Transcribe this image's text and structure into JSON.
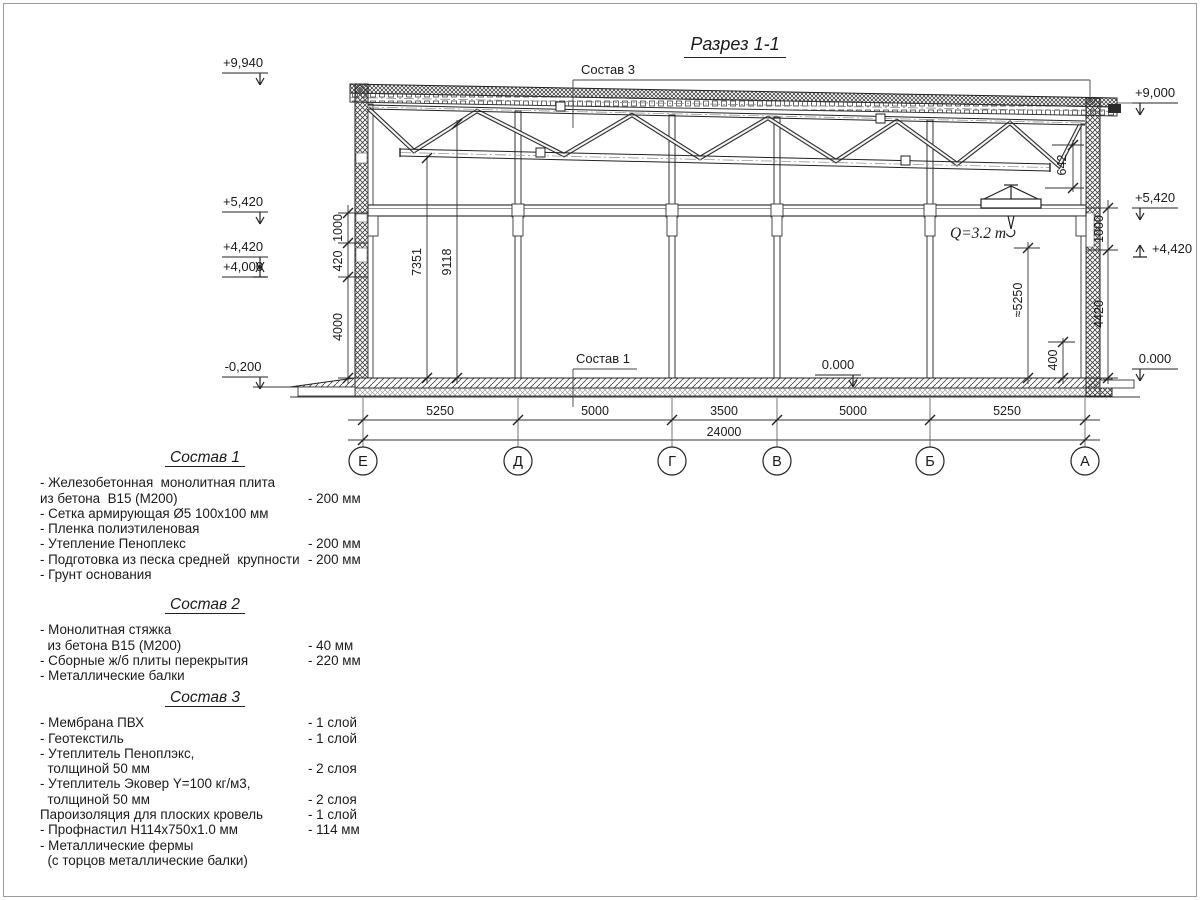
{
  "page": {
    "title": "Разрез 1-1"
  },
  "drawing": {
    "leaders": {
      "sostav3": "Состав 3",
      "sostav1": "Состав 1"
    },
    "crane_label": "Q=3.2 т",
    "elev": {
      "l1": "+9,940",
      "l2": "+5,420",
      "l3": "+4,420",
      "l4": "+4,000",
      "l5": "-0,200",
      "r1": "+9,000",
      "r2": "+5,420",
      "r3": "+4,420",
      "r4": "0.000",
      "inner0": "0.000"
    },
    "dims": {
      "left1": "1000",
      "left2": "420",
      "left3": "4000",
      "right1": "1000",
      "right2": "4420",
      "right3": "400",
      "truss": "642",
      "craneh": "≈5250",
      "bay1a": "7351",
      "bay1b": "9118",
      "b1": "5250",
      "b2": "5000",
      "b3": "3500",
      "b4": "5000",
      "b5": "5250",
      "total": "24000"
    },
    "axes": [
      "Е",
      "Д",
      "Г",
      "В",
      "Б",
      "А"
    ]
  },
  "compositions": [
    {
      "title": "Состав 1",
      "items": [
        {
          "text": "- Железобетонная  монолитная плита",
          "value": ""
        },
        {
          "text": "из бетона  В15 (М200)",
          "value": "- 200 мм"
        },
        {
          "text": "- Сетка армирующая Ø5 100х100 мм",
          "value": ""
        },
        {
          "text": "- Пленка полиэтиленовая",
          "value": ""
        },
        {
          "text": "- Утепление Пеноплекс",
          "value": "- 200 мм"
        },
        {
          "text": "- Подготовка из песка средней  крупности",
          "value": "- 200 мм"
        },
        {
          "text": "- Грунт основания",
          "value": ""
        }
      ]
    },
    {
      "title": "Состав 2",
      "items": [
        {
          "text": "- Монолитная стяжка",
          "value": ""
        },
        {
          "text": "  из бетона В15 (М200)",
          "value": "- 40 мм"
        },
        {
          "text": "- Сборные ж/б плиты перекрытия",
          "value": "- 220 мм"
        },
        {
          "text": "- Металлические балки",
          "value": ""
        }
      ]
    },
    {
      "title": "Состав 3",
      "items": [
        {
          "text": "- Мембрана ПВХ",
          "value": "- 1 слой"
        },
        {
          "text": "- Геотекстиль",
          "value": "- 1 слой"
        },
        {
          "text": "- Утеплитель Пеноплэкс,",
          "value": ""
        },
        {
          "text": "  толщиной 50 мм",
          "value": "- 2 слоя"
        },
        {
          "text": "- Утеплитель Эковер Y=100 кг/м3,",
          "value": ""
        },
        {
          "text": "  толщиной 50 мм",
          "value": "- 2 слоя"
        },
        {
          "text": "Пароизоляция для плоских кровель",
          "value": "- 1 слой"
        },
        {
          "text": "- Профнастил Н114х750х1.0 мм",
          "value": "- 114 мм"
        },
        {
          "text": "- Металлические фермы",
          "value": ""
        },
        {
          "text": "  (с торцов металлические балки)",
          "value": ""
        }
      ]
    }
  ]
}
